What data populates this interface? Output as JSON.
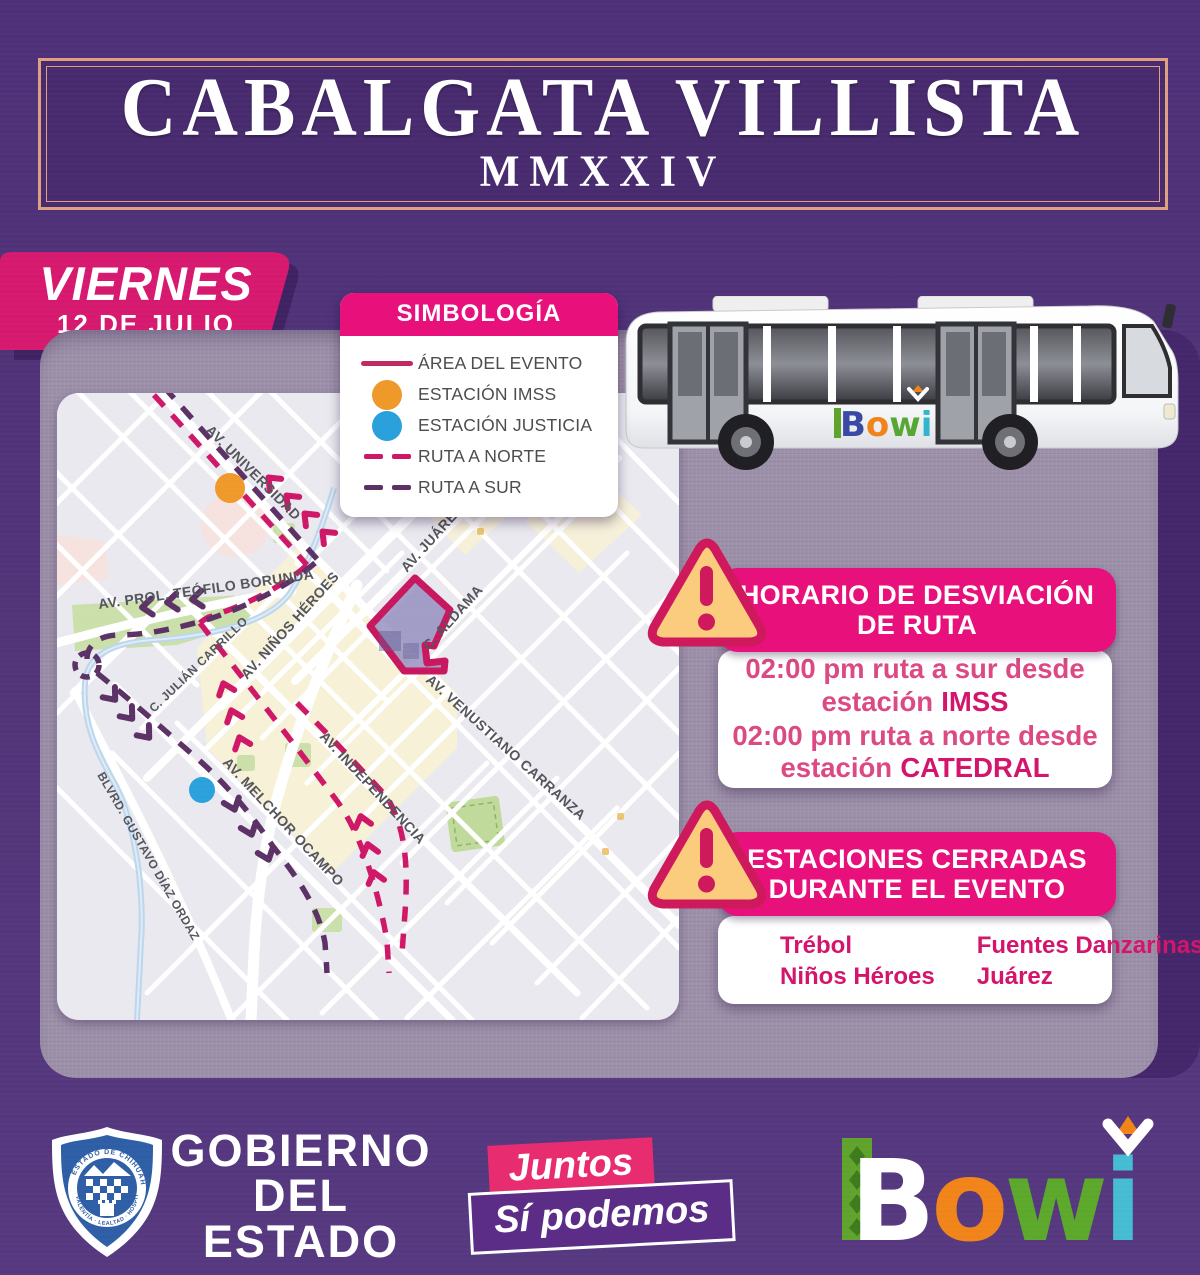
{
  "header": {
    "title": "CABALGATA VILLISTA",
    "year": "MMXXIV"
  },
  "date_badge": {
    "day": "VIERNES",
    "date": "12 DE JULIO"
  },
  "legend": {
    "title": "SIMBOLOGÍA",
    "items": [
      {
        "label": "ÁREA DEL EVENTO",
        "icon": "event-area-line",
        "color": "#C02A62"
      },
      {
        "label": "ESTACIÓN IMSS",
        "icon": "station-dot",
        "color": "#F0992B"
      },
      {
        "label": "ESTACIÓN JUSTICIA",
        "icon": "station-dot",
        "color": "#2BA1DB"
      },
      {
        "label": "RUTA A NORTE",
        "icon": "dashed-line",
        "color": "#CF1767"
      },
      {
        "label": "RUTA A SUR",
        "icon": "dashed-line",
        "color": "#5C3166"
      }
    ]
  },
  "bus": {
    "logo": "Bowi",
    "letters": [
      "B",
      "o",
      "w",
      "i"
    ]
  },
  "map": {
    "street_labels": [
      "AV. UNIVERSIDAD",
      "AV. PROL. TEÓFILO BORUNDA",
      "AV. JUÁREZ",
      "C. ALDAMA",
      "AV. NIÑOS HÉROES",
      "C. JULIÁN CARRILLO",
      "AV. MELCHOR OCAMPO",
      "AV. INDEPENDENCIA",
      "AV. VENUSTIANO CARRANZA",
      "BLVRD. GUSTAVO DÍAZ ORDAZ"
    ],
    "stations": [
      {
        "name": "IMSS",
        "color": "#F0992B"
      },
      {
        "name": "JUSTICIA",
        "color": "#2BA1DB"
      }
    ],
    "colors": {
      "ruta_norte": "#CF1767",
      "ruta_sur": "#5C3166",
      "area_evento": "#C8175E"
    }
  },
  "alerts": [
    {
      "title_line1": "HORARIO DE DESVIACIÓN",
      "title_line2": "DE RUTA",
      "lines": [
        {
          "text": "02:00 pm  ruta a sur desde estación",
          "station": "IMSS"
        },
        {
          "text": "02:00 pm  ruta a norte desde estación",
          "station": "CATEDRAL"
        }
      ]
    },
    {
      "title_line1": "ESTACIONES CERRADAS",
      "title_line2": "DURANTE EL EVENTO",
      "stations": [
        "Trébol",
        "Fuentes Danzarinas",
        "Niños Héroes",
        "Juárez"
      ]
    }
  ],
  "footer": {
    "government": {
      "line1": "GOBIERNO",
      "line2": "DEL ESTADO",
      "line3": "DE CHIHUAHUA",
      "shield_top": "ESTADO DE CHIHUAHUA",
      "shield_bottom": "VALENTÍA · LEALTAD · HOSPITALIDAD"
    },
    "slogan": {
      "line1": "Juntos",
      "line2": "Sí podemos"
    },
    "brand": {
      "name": "Bowi"
    }
  }
}
